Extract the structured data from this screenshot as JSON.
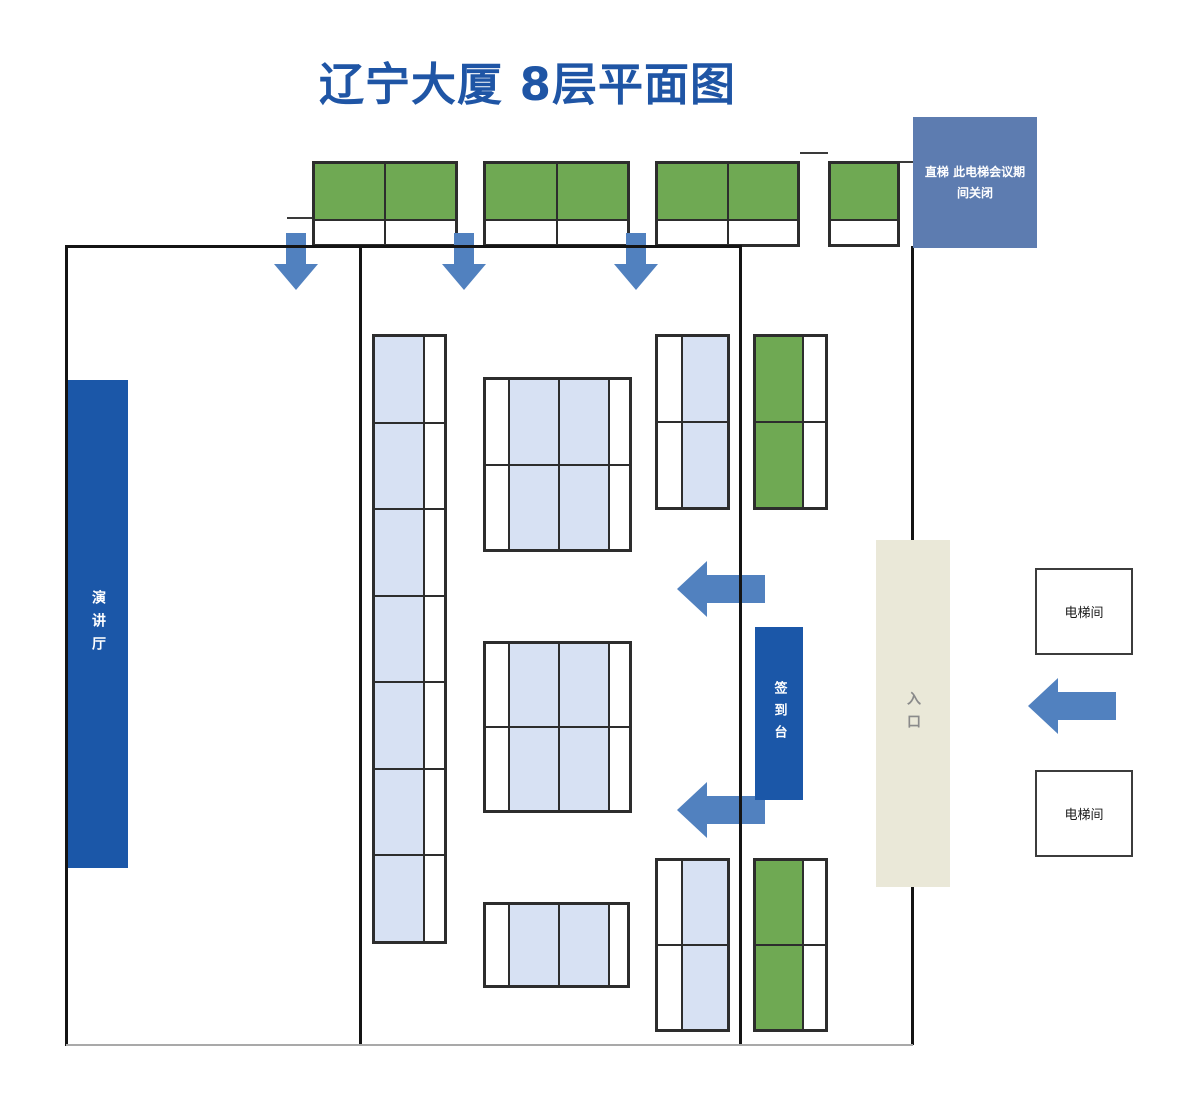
{
  "title": "辽宁大厦 8层平面图",
  "labels": {
    "elevator_closed": "直梯 此电梯会议期间关闭",
    "lecture_hall": "演讲厅",
    "sign_in_desk": "签到台",
    "entrance": "入口",
    "elevator_rooms": [
      "电梯间",
      "电梯间"
    ]
  },
  "colors": {
    "title": "#1f55a5",
    "ink": "#1b57a8",
    "green": "#6fa953",
    "lightblue": "#d7e1f3",
    "steel": "#5d7cb0",
    "arrow": "#5181bf",
    "beige": "#eae8d8",
    "wall": "#141414",
    "wallgray": "#a9a9a9",
    "border": "#2d2d2d",
    "entrance_text": "#8a8a8a"
  }
}
